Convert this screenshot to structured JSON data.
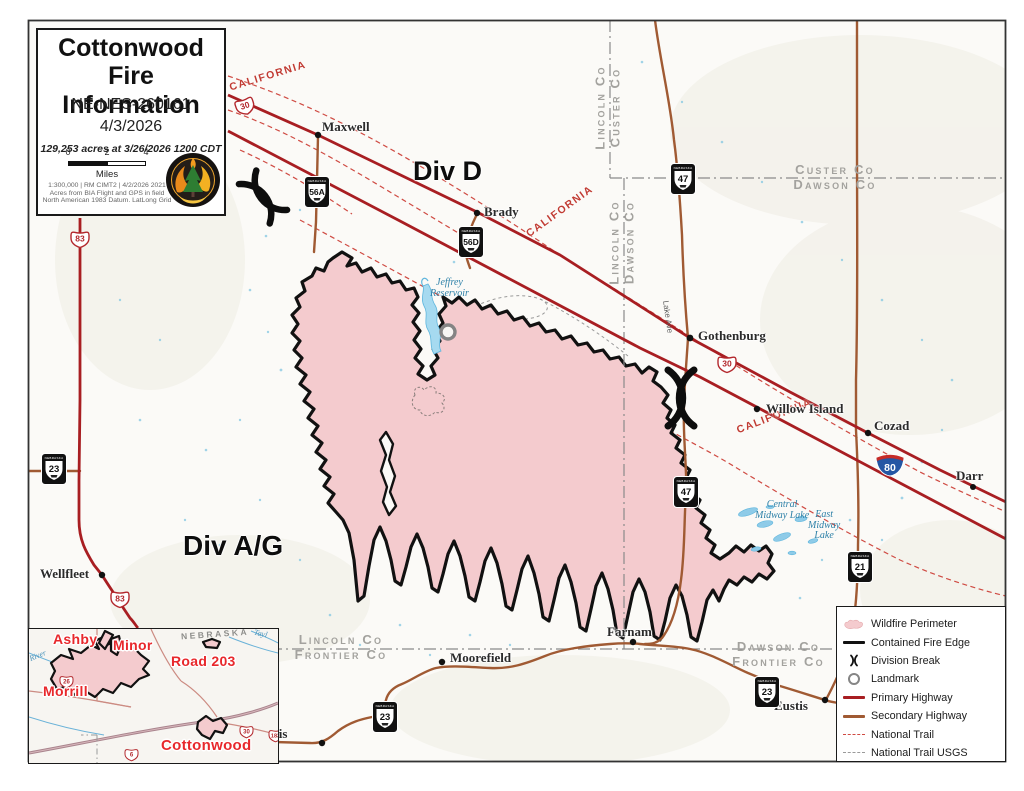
{
  "title_box": {
    "line1": "Cottonwood",
    "line2": "Fire Information",
    "incident": "NE-NES-260161",
    "date": "4/3/2026",
    "acres": "129,253 acres at 3/26/2026 1200 CDT",
    "scale": {
      "zero": "0",
      "two": "2",
      "four": "4",
      "unit": "Miles"
    },
    "credits": [
      "1:300,000  |  RM CIMT2  |  4/2/2026 2021",
      "Acres from BIA Flight and GPS in field",
      "North American 1983 Datum. LatLong Grid"
    ]
  },
  "divisions": {
    "d": "Div D",
    "ag": "Div A/G"
  },
  "trail_label": "CALIFORNIA",
  "roads": {
    "lake_ave": "Lake Ave"
  },
  "counties": {
    "lincoln_custer": {
      "a": "Lincoln Co",
      "b": "Custer Co"
    },
    "custer_dawson": {
      "a": "Custer Co",
      "b": "Dawson Co"
    },
    "lincoln_dawson": {
      "a": "Lincoln Co",
      "b": "Dawson Co"
    },
    "lincoln_frontier": {
      "a": "Lincoln Co",
      "b": "Frontier Co"
    },
    "dawson_frontier": {
      "a": "Dawson Co",
      "b": "Frontier Co"
    }
  },
  "towns": {
    "maxwell": "Maxwell",
    "brady": "Brady",
    "gothenburg": "Gothenburg",
    "willow_island": "Willow Island",
    "cozad": "Cozad",
    "darr": "Darr",
    "wellfleet": "Wellfleet",
    "curtis": "Curtis",
    "moorefield": "Moorefield",
    "farnam": "Farnam",
    "eustis": "Eustis"
  },
  "waters": {
    "jeffrey1": "Jeffrey",
    "jeffrey2": "Reservoir",
    "central1": "Central",
    "central2": "Midway Lake",
    "east1": "East",
    "east2": "Midway",
    "east3": "Lake"
  },
  "shields": {
    "state": "NEBRASKA",
    "us30": "30",
    "us83": "83",
    "i80": "80",
    "ne23": "23",
    "ne47": "47",
    "ne21": "21",
    "ne56a": "56A",
    "ne56d": "56D",
    "us26": "26",
    "us6": "6",
    "us183": "183"
  },
  "inset": {
    "state": "NEBRASKA",
    "fires": {
      "ashby": "Ashby",
      "minor": "Minor",
      "road203": "Road 203",
      "morrill": "Morrill",
      "cottonwood": "Cottonwood"
    },
    "river": "River",
    "tayl": "Tayl"
  },
  "legend": {
    "items": [
      {
        "icon": "wildfire-perimeter-swatch",
        "label": "Wildfire Perimeter"
      },
      {
        "icon": "contained-fire-edge-line",
        "label": "Contained Fire Edge"
      },
      {
        "icon": "division-break-symbol",
        "label": "Division Break"
      },
      {
        "icon": "landmark-ring",
        "label": "Landmark"
      },
      {
        "icon": "primary-highway-line",
        "label": "Primary Highway"
      },
      {
        "icon": "secondary-highway-line",
        "label": "Secondary Highway"
      },
      {
        "icon": "national-trail-dash",
        "label": "National Trail"
      },
      {
        "icon": "national-trail-usgs-dash",
        "label": "National Trail USGS"
      }
    ]
  },
  "colors": {
    "fire_fill": "#f4cbce",
    "fire_edge": "#111111",
    "primary_highway": "#a81e22",
    "secondary_highway": "#a05a33",
    "national_trail": "#cf4a42",
    "national_trail_usgs": "#9a9a9a",
    "county_line": "#8a8a8a",
    "water": "#6ab2d8",
    "inset_fire_label": "#e8282c"
  }
}
